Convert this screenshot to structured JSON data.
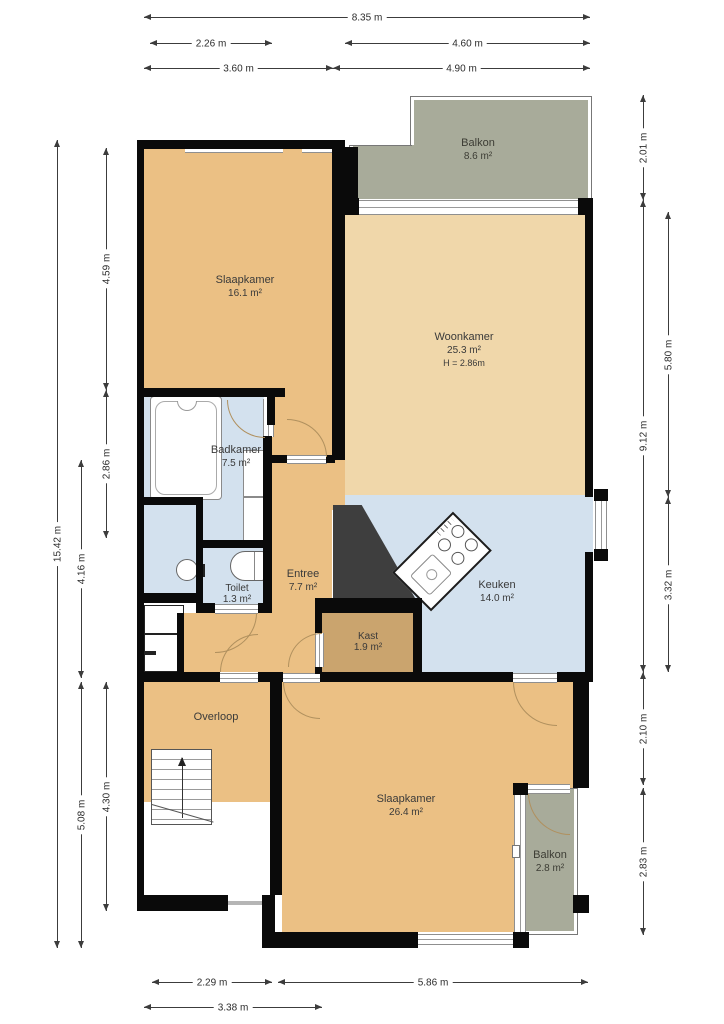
{
  "rooms": {
    "bedroom1": {
      "name": "Slaapkamer",
      "area": "16.1 m²"
    },
    "livingroom": {
      "name": "Woonkamer",
      "area": "25.3 m²",
      "ceiling": "H = 2.86m"
    },
    "balcony_top": {
      "name": "Balkon",
      "area": "8.6 m²"
    },
    "bathroom": {
      "name": "Badkamer",
      "area": "7.5 m²"
    },
    "toilet": {
      "name": "Toilet",
      "area": "1.3 m²"
    },
    "hall": {
      "name": "Entree",
      "area": "7.7 m²"
    },
    "kitchen": {
      "name": "Keuken",
      "area": "14.0 m²"
    },
    "closet": {
      "name": "Kast",
      "area": "1.9 m²"
    },
    "landing": {
      "name": "Overloop"
    },
    "bedroom2": {
      "name": "Slaapkamer",
      "area": "26.4 m²"
    },
    "balcony_bottom": {
      "name": "Balkon",
      "area": "2.8 m²"
    }
  },
  "dimensions": {
    "top_total": "8.35 m",
    "top_left_a": "2.26 m",
    "top_right_a": "4.60 m",
    "top_left_b": "3.60 m",
    "top_right_b": "4.90 m",
    "bottom_left_a": "2.29 m",
    "bottom_right_a": "5.86 m",
    "bottom_left_b": "3.38 m",
    "left_total": "15.42 m",
    "left_bedroom": "4.59 m",
    "left_bathroom": "2.86 m",
    "left_landing": "4.30 m",
    "left_hall": "4.16 m",
    "left_block": "5.08 m",
    "right_balcony": "2.01 m",
    "right_main": "9.12 m",
    "right_living": "5.80 m",
    "right_kitchen": "3.32 m",
    "right_gap": "2.10 m",
    "right_balcony2": "2.83 m"
  },
  "colors": {
    "room": "#ebc084",
    "living": "#f0d7aa",
    "wet": "#d3e1ee",
    "closet": "#caa46e",
    "balcony": "#a8ab9a",
    "wall": "#0a0a0a",
    "arc": "#b0905e",
    "dim": "#3c3c3c",
    "wedge": "#3e3e3e"
  }
}
